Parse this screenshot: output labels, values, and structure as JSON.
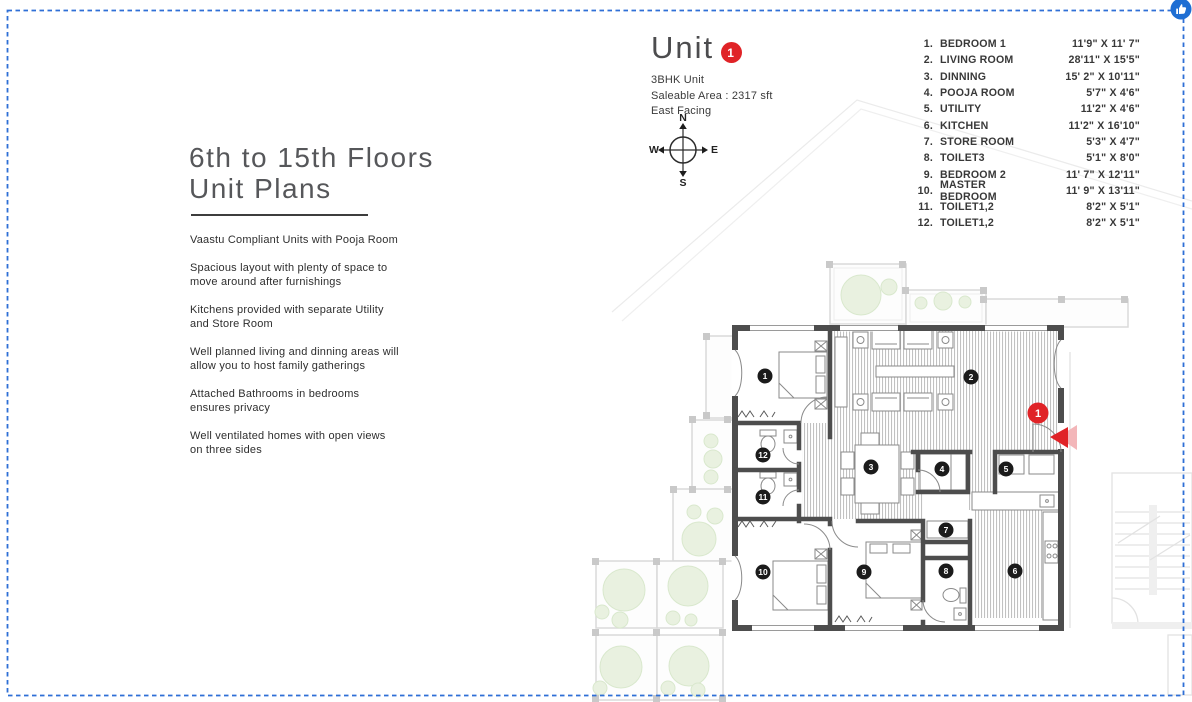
{
  "colors": {
    "border_blue": "#2e6fd6",
    "accent_red": "#e02327",
    "badge_black": "#1b1b1b",
    "tree_green": "#e9f1e0",
    "wall_gray": "#4d4d4d",
    "stripe_gray": "#b6b6b6"
  },
  "left_panel": {
    "title": "6th to 15th Floors\nUnit Plans",
    "features": [
      "Vaastu Compliant Units with Pooja Room",
      "Spacious layout with plenty of space to\nmove around after furnishings",
      "Kitchens provided with separate Utility\nand Store Room",
      "Well planned living and dinning areas will\nallow you to host family gatherings",
      "Attached Bathrooms in bedrooms\nensures privacy",
      "Well ventilated homes with open views\non three sides"
    ]
  },
  "unit_header": {
    "title": "Unit",
    "badge": "1",
    "subtitle_lines": [
      "3BHK Unit",
      "Saleable Area : 2317 sft",
      "East Facing"
    ]
  },
  "compass": {
    "north": "N",
    "south": "S",
    "east": "E",
    "west": "W"
  },
  "room_table": {
    "rows": [
      {
        "n": "1.",
        "name": "BEDROOM 1",
        "dims": "11'9\" X 11' 7\""
      },
      {
        "n": "2.",
        "name": "LIVING ROOM",
        "dims": "28'11\" X 15'5\""
      },
      {
        "n": "3.",
        "name": "DINNING",
        "dims": "15' 2\" X 10'11\""
      },
      {
        "n": "4.",
        "name": "POOJA ROOM",
        "dims": "5'7\" X 4'6\""
      },
      {
        "n": "5.",
        "name": "UTILITY",
        "dims": "11'2\" X 4'6\""
      },
      {
        "n": "6.",
        "name": "KITCHEN",
        "dims": "11'2\" X 16'10\""
      },
      {
        "n": "7.",
        "name": "STORE ROOM",
        "dims": "5'3\" X 4'7\""
      },
      {
        "n": "8.",
        "name": "TOILET3",
        "dims": "5'1\" X 8'0\""
      },
      {
        "n": "9.",
        "name": "BEDROOM 2",
        "dims": "11' 7\" X 12'11\""
      },
      {
        "n": "10.",
        "name": "MASTER BEDROOM",
        "dims": "11' 9\" X 13'11\""
      },
      {
        "n": "11.",
        "name": "TOILET1,2",
        "dims": "8'2\" X 5'1\""
      },
      {
        "n": "12.",
        "name": "TOILET1,2",
        "dims": "8'2\" X 5'1\""
      }
    ]
  },
  "plan": {
    "badges": [
      {
        "n": "1",
        "x": 765,
        "y": 376
      },
      {
        "n": "2",
        "x": 971,
        "y": 377
      },
      {
        "n": "3",
        "x": 871,
        "y": 467
      },
      {
        "n": "4",
        "x": 942,
        "y": 469
      },
      {
        "n": "5",
        "x": 1006,
        "y": 469
      },
      {
        "n": "6",
        "x": 1015,
        "y": 571
      },
      {
        "n": "7",
        "x": 946,
        "y": 530
      },
      {
        "n": "8",
        "x": 946,
        "y": 571
      },
      {
        "n": "9",
        "x": 864,
        "y": 572
      },
      {
        "n": "10",
        "x": 763,
        "y": 572
      },
      {
        "n": "11",
        "x": 763,
        "y": 497
      },
      {
        "n": "12",
        "x": 763,
        "y": 455
      }
    ],
    "entrance_badge": {
      "n": "1",
      "x": 1038,
      "y": 413
    }
  }
}
